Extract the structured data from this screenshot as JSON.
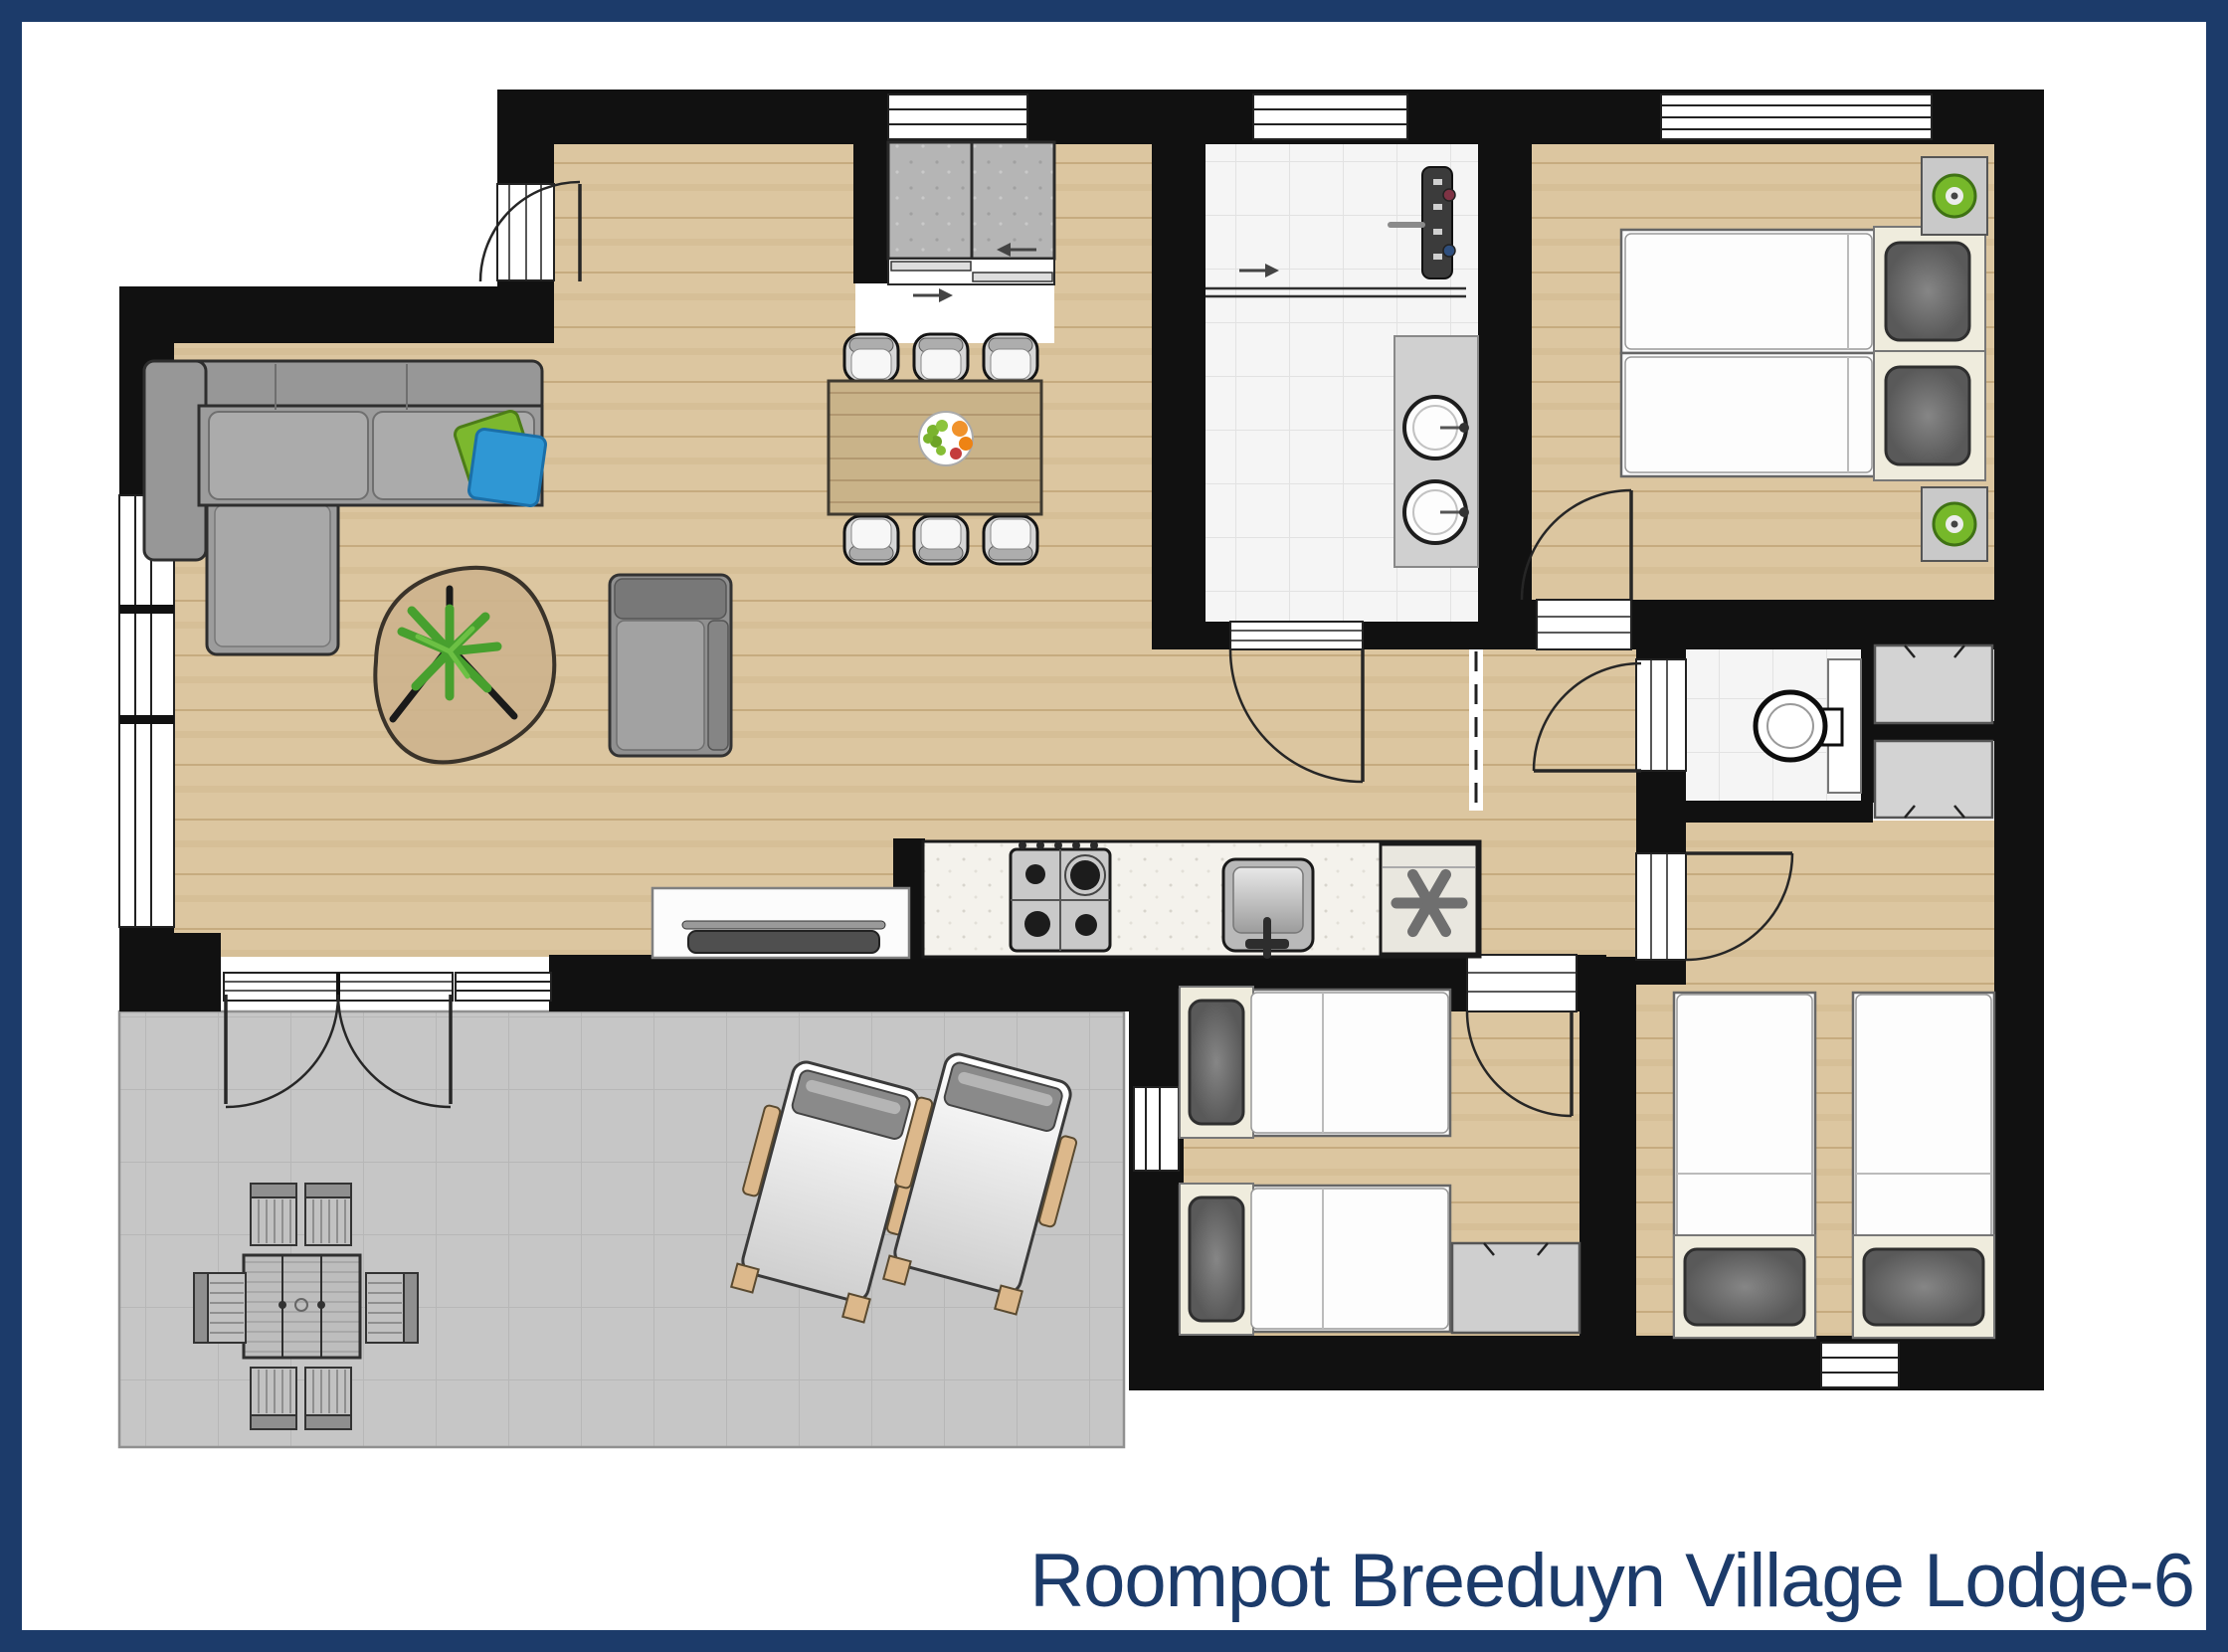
{
  "page": {
    "title_caption": "Roompot Breeduyn Village Lodge-6"
  },
  "frame": {
    "border_color": "#1c3b6a",
    "background": "#ffffff"
  },
  "palette": {
    "wall_black": "#111111",
    "wood_floor": "#dcc6a0",
    "bathroom_tile": "#f5f5f5",
    "terrace_tile": "#c6c6c6",
    "sofa_gray": "#9c9c9c",
    "pillow_green": "#7cb82e",
    "pillow_blue": "#2f97d4",
    "lamp_green": "#76b82a",
    "plant_green": "#47a02e",
    "fruit_orange": "#f0922b",
    "fruit_red": "#c43c3c",
    "fruit_grape_green": "#7ab32e"
  },
  "symbols": {
    "fridge_marker": "six-spoke asterisk",
    "sliding_door_arrow_right": "→",
    "sliding_door_arrow_left": "←"
  }
}
